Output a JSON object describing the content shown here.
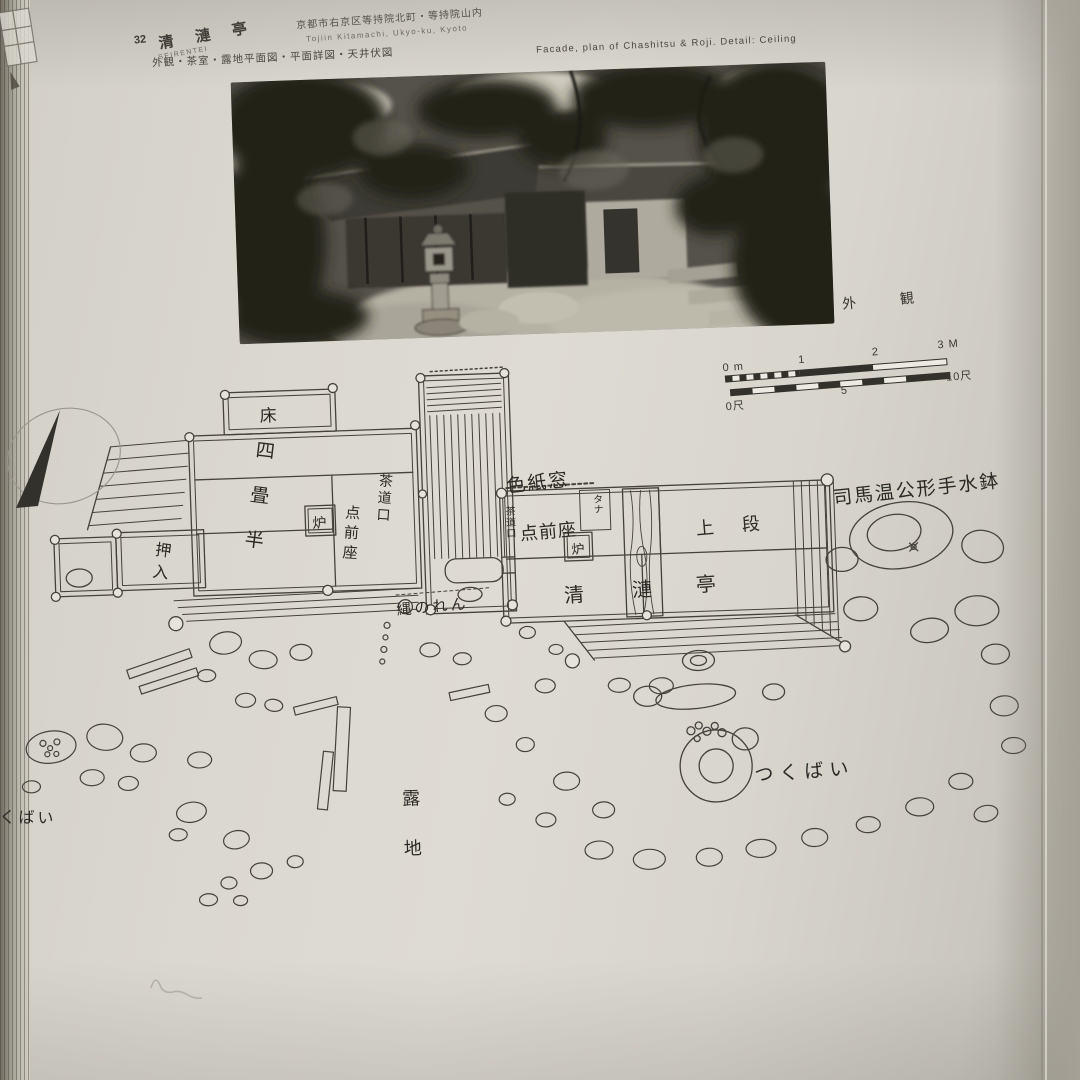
{
  "header": {
    "number": "32",
    "title_jp": "清 漣 亭",
    "title_romaji": "SEIRENTEI",
    "address_jp": "京都市右京区等持院北町・等持院山内",
    "address_romaji": "Tojiin Kitamachi, Ukyo-ku, Kyoto",
    "contents_jp": "外観・茶室・露地平面図・平面詳図・天井伏図",
    "contents_en": "Facade, plan of Chashitsu & Roji. Detail: Ceiling"
  },
  "photo": {
    "caption": "外　観"
  },
  "scale_bar": {
    "m0": "0 m",
    "m1": "1",
    "m2": "2",
    "m3": "3 M",
    "s0": "0尺",
    "s5": "5",
    "s10": "10尺"
  },
  "plan_labels": {
    "tokonoma": "床",
    "four_half_mat": "四畳半",
    "hearth_left": "炉",
    "host_mat_left": "点前座",
    "tea_door_left": "茶道口",
    "closet": "押入",
    "shikishi_window": "色紙窓",
    "tea_door_right": "茶道口",
    "host_mat_right": "点前座",
    "shelf": "タナ",
    "hearth_right": "炉",
    "upper_level": "上段",
    "sei": "清",
    "ren": "漣",
    "tei": "亭",
    "rope_curtain": "縄のれん",
    "water_basin": "司馬温公形手水鉢",
    "tsukubai": "つくばい",
    "tsukubai_cut": "くばい",
    "roji": "露地"
  }
}
